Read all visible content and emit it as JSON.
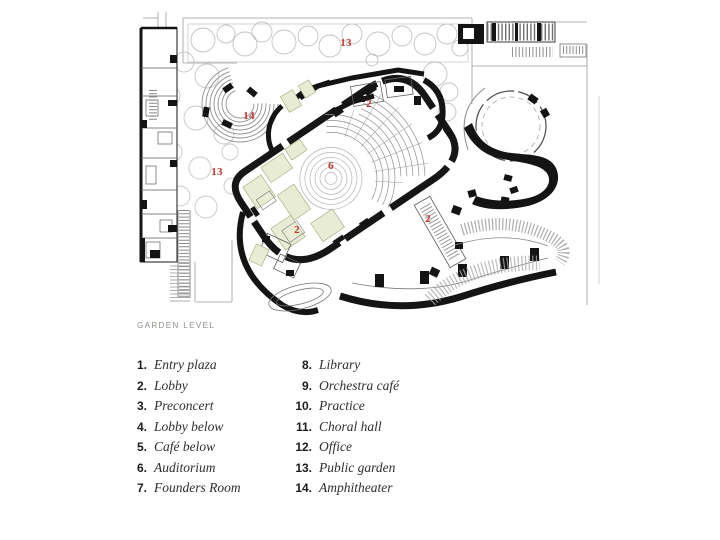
{
  "slide": {
    "background": "#ffffff",
    "level_label": "GARDEN LEVEL"
  },
  "colors": {
    "label_red": "#b8433a",
    "wall_black": "#141414",
    "tint_green": "#e9ecd4",
    "line_gray": "#8f8f8f"
  },
  "plan": {
    "type": "architectural-floor-plan",
    "labels": [
      {
        "num": "13"
      },
      {
        "num": "2"
      },
      {
        "num": "14"
      },
      {
        "num": "13"
      },
      {
        "num": "6"
      },
      {
        "num": "2"
      },
      {
        "num": "2"
      }
    ]
  },
  "legend": {
    "col1": [
      {
        "num": "1.",
        "label": "Entry plaza"
      },
      {
        "num": "2.",
        "label": "Lobby"
      },
      {
        "num": "3.",
        "label": "Preconcert"
      },
      {
        "num": "4.",
        "label": "Lobby below"
      },
      {
        "num": "5.",
        "label": "Café below"
      },
      {
        "num": "6.",
        "label": "Auditorium"
      },
      {
        "num": "7.",
        "label": "Founders Room"
      }
    ],
    "col2": [
      {
        "num": "8.",
        "label": "Library"
      },
      {
        "num": "9.",
        "label": "Orchestra café"
      },
      {
        "num": "10.",
        "label": "Practice"
      },
      {
        "num": "11.",
        "label": "Choral hall"
      },
      {
        "num": "12.",
        "label": "Office"
      },
      {
        "num": "13.",
        "label": "Public garden"
      },
      {
        "num": "14.",
        "label": "Amphitheater"
      }
    ]
  }
}
